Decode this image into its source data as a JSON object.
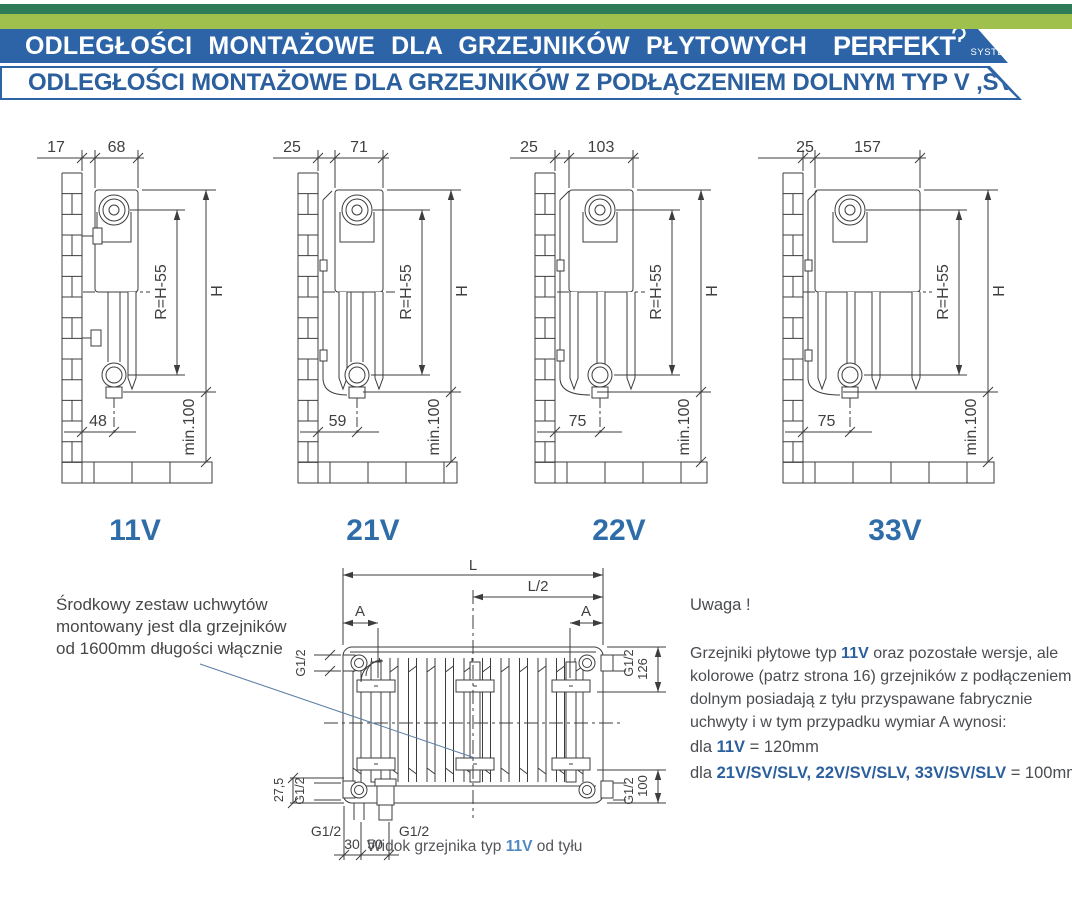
{
  "header": {
    "title": "ODLEGŁOŚCI MONTAŻOWE DLA GRZEJNIKÓW PŁYTOWYCH",
    "brand": "PERFEKT",
    "brand_sub": "SYSTEM",
    "subtitle": "ODLEGŁOŚCI MONTAŻOWE DLA GRZEJNIKÓW Z PODŁĄCZENIEM DOLNYM TYP V ,SV ,SLV"
  },
  "colors": {
    "bar_dark_green": "#2e7b57",
    "bar_light_green": "#a0c04e",
    "banner_blue": "#2d64a8",
    "subtitle_blue": "#2b5f9e",
    "type_label_blue": "#2e6da8",
    "highlight_blue": "#2b5f9e",
    "caption_highlight": "#5189c2",
    "line": "#3d3d3d",
    "dim_text": "#3f3f3f",
    "leader": "#5b7fa6"
  },
  "side_diagrams": {
    "shared": {
      "radius_label": "R=H-55",
      "height_label": "H",
      "min_floor_label": "min.100"
    },
    "items": [
      {
        "type": "11V",
        "wall_gap": "17",
        "depth": "68",
        "bottom_offset": "48"
      },
      {
        "type": "21V",
        "wall_gap": "25",
        "depth": "71",
        "bottom_offset": "59"
      },
      {
        "type": "22V",
        "wall_gap": "25",
        "depth": "103",
        "bottom_offset": "75"
      },
      {
        "type": "33V",
        "wall_gap": "25",
        "depth": "157",
        "bottom_offset": "75"
      }
    ]
  },
  "rear_view": {
    "length_label": "L",
    "half_length_label": "L/2",
    "bracket_offset_label": "A",
    "thread_label": "G1/2",
    "top_tab_dim": "126",
    "bottom_tab_dim": "100",
    "corner_dim": "27,5",
    "pipe_dim_1": "30",
    "pipe_dim_2": "50",
    "caption": [
      {
        "text": "Widok grzejnika typ ",
        "hl": false
      },
      {
        "text": "11V",
        "hl": true
      },
      {
        "text": " od tyłu",
        "hl": false
      }
    ]
  },
  "notes": {
    "left_note_lines": [
      "Środkowy zestaw uchwytów",
      "montowany jest dla grzejników",
      "od 1600mm długości włącznie"
    ],
    "warning": {
      "title": "Uwaga !",
      "paragraph": [
        [
          {
            "text": "Grzejniki płytowe typ ",
            "hl": false
          },
          {
            "text": "11V",
            "hl": true
          },
          {
            "text": " oraz pozostałe wersje, ale",
            "hl": false
          }
        ],
        [
          {
            "text": "kolorowe (patrz strona 16) grzejników z podłączeniem",
            "hl": false
          }
        ],
        [
          {
            "text": "dolnym posiadają z tyłu przyspawane fabrycznie",
            "hl": false
          }
        ],
        [
          {
            "text": "uchwyty i w tym przypadku wymiar A wynosi:",
            "hl": false
          }
        ]
      ],
      "rules": [
        [
          {
            "text": "dla ",
            "hl": false
          },
          {
            "text": "11V",
            "hl": true
          },
          {
            "text": " = 120mm",
            "hl": false
          }
        ],
        [
          {
            "text": "dla ",
            "hl": false
          },
          {
            "text": "21V/SV/SLV, 22V/SV/SLV, 33V/SV/SLV",
            "hl": true
          },
          {
            "text": " = 100mm",
            "hl": false
          }
        ]
      ]
    }
  }
}
